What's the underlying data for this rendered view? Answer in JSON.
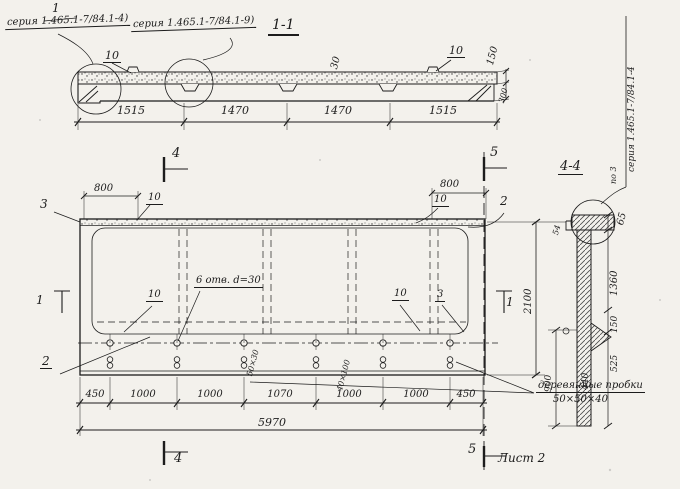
{
  "colors": {
    "ink": "#1c1c1c",
    "paper": "#f3f1ec"
  },
  "section_1_1": {
    "title": "1-1",
    "pos_1": "1",
    "callout_left": "серия 1.465.1-7/84.1-4)",
    "callout_right": "серия 1.465.1-7/84.1-9)",
    "label_10_left": "10",
    "label_10_right": "10",
    "label_30": "30",
    "label_150": "150",
    "label_300": "300",
    "dims": [
      "1515",
      "1470",
      "1470",
      "1515"
    ]
  },
  "plan": {
    "mark_4_top": "4",
    "mark_4_bottom": "4",
    "mark_5_top": "5",
    "mark_5_bottom": "5",
    "mark_1_left": "1",
    "mark_1_right": "1",
    "pos_3_left": "3",
    "pos_2_top_right": "2",
    "pos_2_bottom_left": "2",
    "pos_3_inner": "3",
    "dim_800_left": "800",
    "dim_800_right": "800",
    "label_10_top_left": "10",
    "label_10_top_right": "10",
    "label_10_inner_left": "10",
    "label_10_inner_right": "10",
    "holes_note": "6 отв. d=30",
    "slot_label_a": "50×30",
    "slot_label_b": "40×100",
    "bottom_dims": [
      "450",
      "1000",
      "1000",
      "1070",
      "1000",
      "1000",
      "450"
    ],
    "dim_total": "5970",
    "dim_height": "2100",
    "plugs_note_line1": "деревянные пробки",
    "plugs_note_line2": "50×50×40",
    "sheet_ref": "Лист 2"
  },
  "section_4_4": {
    "title": "4-4",
    "series_vertical": "серия 1.465.1-7/84.1-4",
    "po_3": "по 3",
    "dim_65": "65",
    "dim_54": "54",
    "dim_1360": "1360",
    "dim_150": "150",
    "dim_525": "525",
    "dim_440": "440",
    "dim_900": "900"
  }
}
